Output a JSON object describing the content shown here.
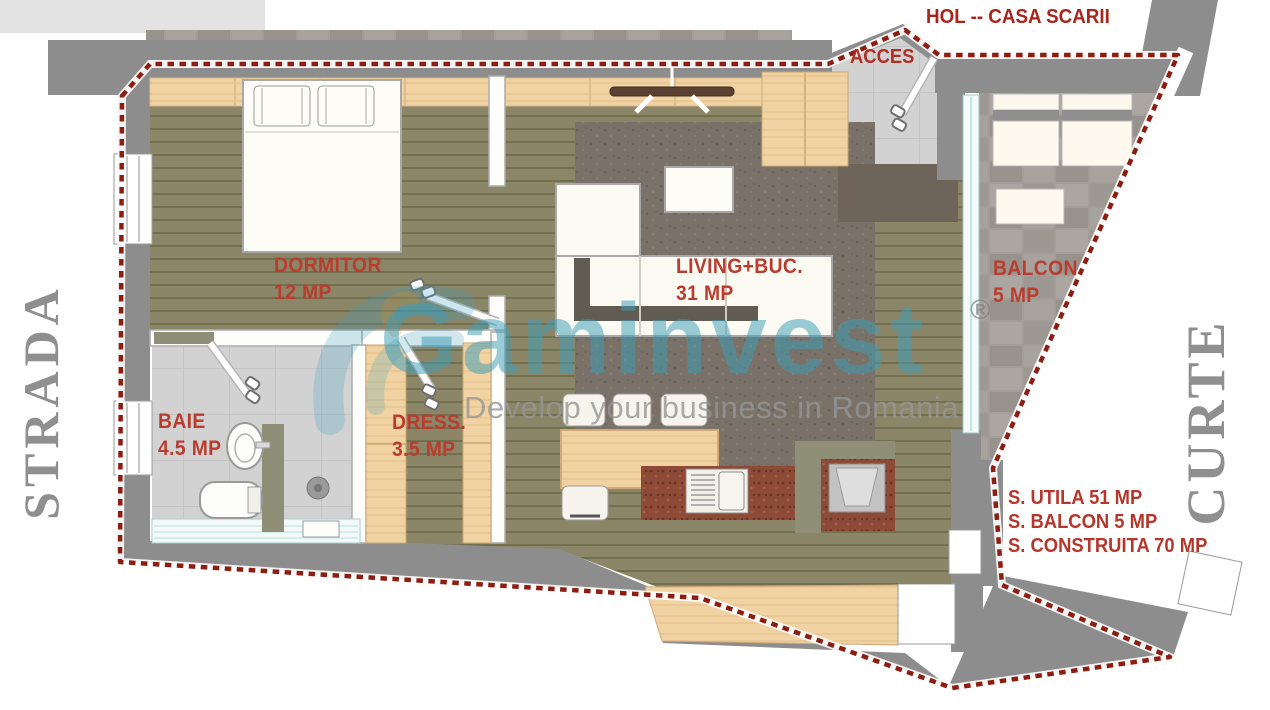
{
  "labels": {
    "hol": "HOL -- CASA SCARII",
    "acces": "ACCES",
    "strada": "STRADA",
    "curte": "CURTE"
  },
  "rooms": [
    {
      "id": "dormitor",
      "name": "DORMITOR",
      "area": "12 MP"
    },
    {
      "id": "baie",
      "name": "BAIE",
      "area": "4.5 MP"
    },
    {
      "id": "dress",
      "name": "DRESS.",
      "area": "3.5 MP"
    },
    {
      "id": "living",
      "name": "LIVING+BUC.",
      "area": "31 MP"
    },
    {
      "id": "balcon",
      "name": "BALCON",
      "area": "5 MP"
    }
  ],
  "summary": {
    "lines": [
      "S. UTILA 51 MP",
      "S. BALCON 5 MP",
      "S. CONSTRUITA 70 MP"
    ]
  },
  "watermark": {
    "brand": "Gaminvest",
    "registered": "®",
    "tagline": "Develop your business in Romania"
  },
  "colors": {
    "label_red": "#b93c2e",
    "boundary_red": "#8c1d10",
    "wall_gray": "#8d8d8d",
    "side_label_gray": "#8f8f8f",
    "watermark_teal": "#3e9db9",
    "floor_olive": "#8b8668",
    "wood_light": "#f1d2a2",
    "tile_gray": "#d2d2d2",
    "balcony_stone": "#a29d98",
    "rug_gray": "#7a7268",
    "counter_granite": "#8d4b37"
  }
}
